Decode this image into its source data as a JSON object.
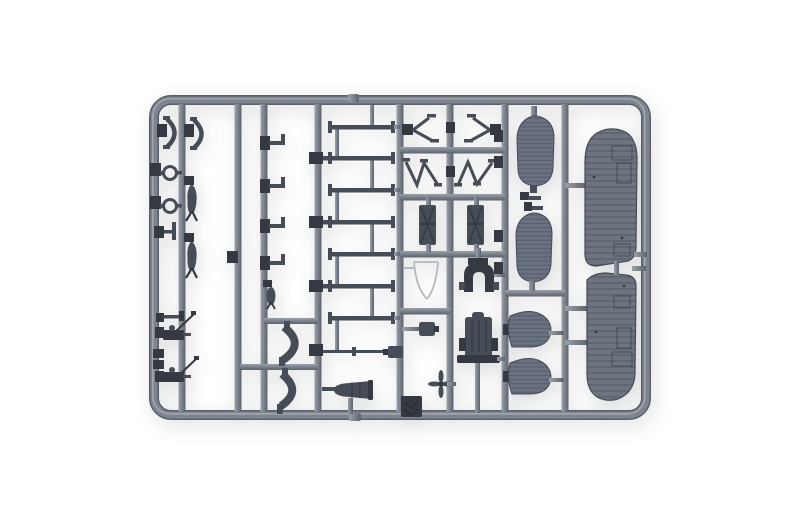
{
  "photo": {
    "subject": "Gray injection-molded plastic model aircraft kit sprue (runner frame with attached parts)",
    "background": "plain white studio background"
  },
  "palette": {
    "bg": "#ffffff",
    "rail": "#7d848e",
    "rail-light": "#9ba1a9",
    "rail-dark": "#5d636d",
    "rail-edge": "#59606a",
    "part": "#474d57",
    "part-dark": "#343942",
    "wing": "#6d7480",
    "wing-edge": "#474d57",
    "float": "#6a7180",
    "thin-part": "#b5b9bf",
    "rib": "rgba(28,33,43,0.30)"
  },
  "parts": [
    {
      "id": "wing-half-upper",
      "label": "large ribbed wing panel (upper right)"
    },
    {
      "id": "wing-half-lower",
      "label": "large ribbed wing panel (lower right)"
    },
    {
      "id": "float-panel-1",
      "label": "ribbed center-section / float panel (top)"
    },
    {
      "id": "float-panel-2",
      "label": "ribbed center-section / float panel (bottom)"
    },
    {
      "id": "fin-1",
      "label": "tail fin half (upper)"
    },
    {
      "id": "fin-2",
      "label": "tail fin half (lower)"
    },
    {
      "id": "strut-ladder",
      "label": "eight interplane struts on center runner"
    },
    {
      "id": "v-struts",
      "label": "two V-shaped cabane struts"
    },
    {
      "id": "n-struts",
      "label": "two N-shaped struts"
    },
    {
      "id": "radiators",
      "label": "two cross-braced radiator blocks"
    },
    {
      "id": "engine-front",
      "label": "engine front / horseshoe cowl piece"
    },
    {
      "id": "engine-block",
      "label": "engine block"
    },
    {
      "id": "cowling-cone",
      "label": "tapered nose cowling"
    },
    {
      "id": "cowl-arcs",
      "label": "two curved cowl flap bands"
    },
    {
      "id": "windscreen-frame",
      "label": "thin windscreen wire frame"
    },
    {
      "id": "propeller-small",
      "label": "small four-blade propeller"
    },
    {
      "id": "hatch-plate",
      "label": "square hatch plate with chevrons"
    },
    {
      "id": "bombs",
      "label": "two finned bombs"
    },
    {
      "id": "machine-guns",
      "label": "two machine guns with mounting rods"
    },
    {
      "id": "rings",
      "label": "two ring fittings"
    },
    {
      "id": "skids",
      "label": "two curved skid bows"
    },
    {
      "id": "brackets",
      "label": "four small L-brackets"
    }
  ]
}
